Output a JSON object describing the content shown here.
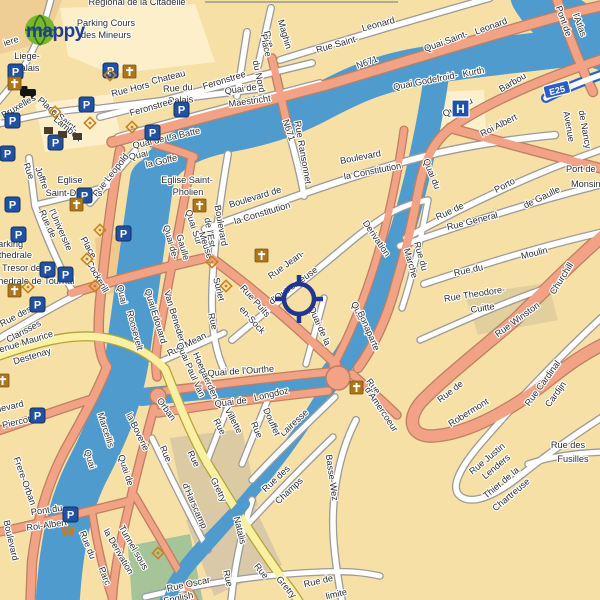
{
  "logo": {
    "text": "mappy"
  },
  "colors": {
    "land": "#f7e0a6",
    "water": "#4f9bce",
    "road_major": "#f2a285",
    "road_major_casing": "#bc8064",
    "road_secondary": "#f9f0a2",
    "road_secondary_casing": "#b3a43c",
    "road_minor": "#ffffff",
    "road_minor_casing": "#9b9b9b",
    "motorway": "#2b5fc7",
    "park": "#a5c497",
    "parking_blue": "#2151a3",
    "poi_orange": "#ad761c",
    "monument_orange": "#c8821c",
    "label_color": "#2e2e2e",
    "crosshair_color": "#22368f"
  },
  "crosshair": {
    "x": 299,
    "y": 299
  },
  "badges": [
    {
      "text": "E25",
      "x": 557,
      "y": 90,
      "r": -14
    }
  ],
  "labels": [
    {
      "t": "Regional de la Citadelle",
      "x": 137,
      "y": 5
    },
    {
      "t": "iere",
      "x": 12,
      "y": 44,
      "r": -18
    },
    {
      "t": "Parking Cours",
      "x": 106,
      "y": 26
    },
    {
      "t": "des Mineurs",
      "x": 106,
      "y": 38
    },
    {
      "t": "Liege-",
      "x": 27,
      "y": 59
    },
    {
      "t": "Palais",
      "x": 27,
      "y": 71
    },
    {
      "t": "Rue du",
      "x": 178,
      "y": 91,
      "r": -4
    },
    {
      "t": "Palais",
      "x": 181,
      "y": 103,
      "r": -4
    },
    {
      "t": "Rue Hors",
      "x": 131,
      "y": 92,
      "r": -14
    },
    {
      "t": "Chateau",
      "x": 169,
      "y": 80,
      "r": -14
    },
    {
      "t": "Feronstree",
      "x": 152,
      "y": 110,
      "r": -16
    },
    {
      "t": "Feronstree",
      "x": 225,
      "y": 83,
      "r": -17
    },
    {
      "t": "Rue",
      "x": 266,
      "y": 40,
      "r": 74
    },
    {
      "t": "Maghin",
      "x": 282,
      "y": 35,
      "r": 74
    },
    {
      "t": "Place",
      "x": 263,
      "y": 46,
      "r": 78
    },
    {
      "t": "du Nord",
      "x": 256,
      "y": 77,
      "r": 78
    },
    {
      "t": "Rue Saint-",
      "x": 338,
      "y": 47,
      "r": -16
    },
    {
      "t": "Leonard",
      "x": 379,
      "y": 27,
      "r": -15
    },
    {
      "t": "N671",
      "x": 368,
      "y": 65,
      "r": -20
    },
    {
      "t": "Quai de",
      "x": 241,
      "y": 92,
      "r": -8
    },
    {
      "t": "Maestricht",
      "x": 250,
      "y": 104,
      "r": -8
    },
    {
      "t": "Quai Saint-",
      "x": 447,
      "y": 44,
      "r": -20
    },
    {
      "t": "Leonard",
      "x": 492,
      "y": 29,
      "r": -20
    },
    {
      "t": "Quai Godefroid-",
      "x": 426,
      "y": 84,
      "r": -11
    },
    {
      "t": "Kurth",
      "x": 474,
      "y": 75,
      "r": -11
    },
    {
      "t": "Pont de",
      "x": 561,
      "y": 22,
      "r": 70
    },
    {
      "t": "l'Atlas",
      "x": 577,
      "y": 26,
      "r": 70
    },
    {
      "t": "Quai du",
      "x": 459,
      "y": 110,
      "r": -27
    },
    {
      "t": "Barbou",
      "x": 514,
      "y": 85,
      "r": -30
    },
    {
      "t": "Roi Albert",
      "x": 500,
      "y": 128,
      "r": -27
    },
    {
      "t": "Avenue",
      "x": 566,
      "y": 127,
      "r": 80
    },
    {
      "t": "de Nancy",
      "x": 582,
      "y": 130,
      "r": 80
    },
    {
      "t": "Quai du",
      "x": 429,
      "y": 175,
      "r": 68
    },
    {
      "t": "N671",
      "x": 286,
      "y": 131,
      "r": 72
    },
    {
      "t": "Quai",
      "x": 139,
      "y": 158,
      "r": -13
    },
    {
      "t": "la Goffe",
      "x": 162,
      "y": 164,
      "r": -13
    },
    {
      "t": "Quai de La Batte",
      "x": 167,
      "y": 141,
      "r": -13
    },
    {
      "t": "Rue Leopold",
      "x": 113,
      "y": 177,
      "r": -52
    },
    {
      "t": "Eglise Saint-",
      "x": 187,
      "y": 183
    },
    {
      "t": "Pholien",
      "x": 188,
      "y": 195
    },
    {
      "t": "Eglise",
      "x": 70,
      "y": 183
    },
    {
      "t": "Saint-D",
      "x": 61,
      "y": 196
    },
    {
      "t": "s",
      "x": 100,
      "y": 196
    },
    {
      "t": "Rue",
      "x": 26,
      "y": 172,
      "r": 70
    },
    {
      "t": "Joffre",
      "x": 39,
      "y": 179,
      "r": 70
    },
    {
      "t": "Place Saint-",
      "x": 56,
      "y": 117,
      "r": 40
    },
    {
      "t": "Lambert",
      "x": 66,
      "y": 131,
      "r": 40
    },
    {
      "t": "Rue de Bruxelles",
      "x": 6,
      "y": 117,
      "r": -30
    },
    {
      "t": "Boulevard de",
      "x": 256,
      "y": 200,
      "r": -17
    },
    {
      "t": "la Constitution",
      "x": 263,
      "y": 216,
      "r": -17
    },
    {
      "t": "Boulevard",
      "x": 361,
      "y": 160,
      "r": -11
    },
    {
      "t": "la Constitution",
      "x": 373,
      "y": 174,
      "r": -11
    },
    {
      "t": "Rue Ransonnet",
      "x": 300,
      "y": 153,
      "r": 80
    },
    {
      "t": "Boulevard",
      "x": 218,
      "y": 226,
      "r": 80
    },
    {
      "t": "de l'Est",
      "x": 207,
      "y": 233,
      "r": 80
    },
    {
      "t": "Quai Sur",
      "x": 191,
      "y": 228,
      "r": 72
    },
    {
      "t": "Meuse",
      "x": 203,
      "y": 246,
      "r": 72
    },
    {
      "t": "Quai de-",
      "x": 168,
      "y": 243,
      "r": 74
    },
    {
      "t": "Gaulle",
      "x": 180,
      "y": 248,
      "r": 74
    },
    {
      "t": "Quai",
      "x": 119,
      "y": 295,
      "r": 78
    },
    {
      "t": "Roosevelt",
      "x": 132,
      "y": 331,
      "r": 75
    },
    {
      "t": "Quai Edouard",
      "x": 153,
      "y": 317,
      "r": 73
    },
    {
      "t": "Van Beneden",
      "x": 172,
      "y": 318,
      "r": 73
    },
    {
      "t": "Rue de",
      "x": 45,
      "y": 225,
      "r": 66
    },
    {
      "t": "l'Universite",
      "x": 58,
      "y": 231,
      "r": 66
    },
    {
      "t": "Place",
      "x": 86,
      "y": 249,
      "r": 60
    },
    {
      "t": "Cockerill",
      "x": 95,
      "y": 278,
      "r": 60
    },
    {
      "t": "Parking",
      "x": -8,
      "y": 247,
      "a": "s"
    },
    {
      "t": "Cathedrale",
      "x": -13,
      "y": 258,
      "a": "s"
    },
    {
      "t": "Tresor de la",
      "x": 2,
      "y": 271,
      "a": "s"
    },
    {
      "t": "Cathedrale de Tournai",
      "x": -16,
      "y": 284,
      "a": "s"
    },
    {
      "t": "Rue des",
      "x": 17,
      "y": 319,
      "r": -28
    },
    {
      "t": "Clarisses",
      "x": 25,
      "y": 334,
      "r": -28
    },
    {
      "t": "Avenue Maurice",
      "x": 22,
      "y": 346,
      "r": -17
    },
    {
      "t": "Destenay",
      "x": 33,
      "y": 359,
      "r": -17
    },
    {
      "t": "Boulevard",
      "x": 4,
      "y": 411,
      "r": -13
    },
    {
      "t": "Piercot",
      "x": 17,
      "y": 425,
      "r": -13
    },
    {
      "t": "Rue Jean-",
      "x": 288,
      "y": 267,
      "r": -36
    },
    {
      "t": "d'Outremeuse",
      "x": 295,
      "y": 288,
      "r": -36
    },
    {
      "t": "Rue Puits",
      "x": 253,
      "y": 303,
      "r": 48
    },
    {
      "t": "en-Sock",
      "x": 250,
      "y": 322,
      "r": 48
    },
    {
      "t": "Surlet",
      "x": 216,
      "y": 290,
      "r": 76
    },
    {
      "t": "Rue",
      "x": 210,
      "y": 322,
      "r": 76
    },
    {
      "t": "Rue Mean",
      "x": 188,
      "y": 347,
      "r": -27
    },
    {
      "t": "Derivation",
      "x": 374,
      "y": 240,
      "r": 56
    },
    {
      "t": "Quai de la",
      "x": 317,
      "y": 327,
      "r": 66
    },
    {
      "t": "Quai",
      "x": 355,
      "y": 312,
      "r": 66
    },
    {
      "t": "Bonaparte",
      "x": 366,
      "y": 332,
      "r": 66
    },
    {
      "t": "Rue du",
      "x": 418,
      "y": 257,
      "r": 74
    },
    {
      "t": "Marche",
      "x": 408,
      "y": 264,
      "r": 74
    },
    {
      "t": "Rue de",
      "x": 451,
      "y": 214,
      "r": -25
    },
    {
      "t": "Porto",
      "x": 506,
      "y": 188,
      "r": -28
    },
    {
      "t": "Rue General",
      "x": 473,
      "y": 224,
      "r": -14
    },
    {
      "t": "de Gaulle",
      "x": 543,
      "y": 200,
      "r": -26
    },
    {
      "t": "Rue du",
      "x": 469,
      "y": 273,
      "r": -12
    },
    {
      "t": "Moulin",
      "x": 535,
      "y": 256,
      "r": -14
    },
    {
      "t": "Port de",
      "x": 566,
      "y": 172,
      "a": "s"
    },
    {
      "t": "Monsin",
      "x": 571,
      "y": 187,
      "a": "s"
    },
    {
      "t": "Rue Theodore-",
      "x": 475,
      "y": 297,
      "r": -9
    },
    {
      "t": "Cuitte",
      "x": 483,
      "y": 311,
      "r": -9
    },
    {
      "t": "Churchill",
      "x": 564,
      "y": 280,
      "r": -58
    },
    {
      "t": "Rue Winston",
      "x": 519,
      "y": 322,
      "r": -36
    },
    {
      "t": "Rue de",
      "x": 452,
      "y": 394,
      "r": -38
    },
    {
      "t": "Robermont",
      "x": 470,
      "y": 415,
      "r": -32
    },
    {
      "t": "Rue Cardinal",
      "x": 545,
      "y": 385,
      "r": -54
    },
    {
      "t": "Cardijn",
      "x": 558,
      "y": 396,
      "r": -54
    },
    {
      "t": "Rue Justin",
      "x": 489,
      "y": 461,
      "r": -40
    },
    {
      "t": "Lenders",
      "x": 498,
      "y": 469,
      "r": -40
    },
    {
      "t": "Thier de la",
      "x": 503,
      "y": 485,
      "r": -40
    },
    {
      "t": "Chartreuse",
      "x": 513,
      "y": 497,
      "r": -40
    },
    {
      "t": "Rue des",
      "x": 568,
      "y": 448
    },
    {
      "t": "Fusilles",
      "x": 573,
      "y": 462
    },
    {
      "t": "Rue",
      "x": 371,
      "y": 388,
      "r": 52
    },
    {
      "t": "d'Amercoeur",
      "x": 379,
      "y": 411,
      "r": 56
    },
    {
      "t": "Quai de l'Ourthe",
      "x": 241,
      "y": 374,
      "r": -4
    },
    {
      "t": "Quai de",
      "x": 231,
      "y": 405,
      "r": -7
    },
    {
      "t": "Longdoz",
      "x": 272,
      "y": 397,
      "r": -13
    },
    {
      "t": "Quai Paul Van",
      "x": 188,
      "y": 371,
      "r": 66
    },
    {
      "t": "Hoegaerden",
      "x": 203,
      "y": 377,
      "r": 66
    },
    {
      "t": "Orban",
      "x": 164,
      "y": 411,
      "r": 54
    },
    {
      "t": "la Boverie",
      "x": 135,
      "y": 433,
      "r": 64
    },
    {
      "t": "Quai de",
      "x": 123,
      "y": 471,
      "r": 72
    },
    {
      "t": "Marcellis",
      "x": 103,
      "y": 431,
      "r": 72
    },
    {
      "t": "Quai",
      "x": 87,
      "y": 460,
      "r": 72
    },
    {
      "t": "Frere-Orban",
      "x": 22,
      "y": 482,
      "r": 70
    },
    {
      "t": "Boulevard",
      "x": 8,
      "y": 541,
      "r": 77
    },
    {
      "t": "Pont du",
      "x": 47,
      "y": 513,
      "r": -8
    },
    {
      "t": "Roi-Albert",
      "x": 47,
      "y": 528,
      "r": -8
    },
    {
      "t": "Rue du",
      "x": 85,
      "y": 546,
      "r": 68
    },
    {
      "t": "Parc",
      "x": 102,
      "y": 577,
      "r": 68
    },
    {
      "t": "Tunnel sous",
      "x": 131,
      "y": 549,
      "r": 60
    },
    {
      "t": "la Derivation",
      "x": 116,
      "y": 553,
      "r": 60
    },
    {
      "t": "Rue",
      "x": 163,
      "y": 455,
      "r": 66
    },
    {
      "t": "d'Harscamp",
      "x": 192,
      "y": 507,
      "r": 66
    },
    {
      "t": "Rue Oscar",
      "x": 189,
      "y": 587,
      "r": -12
    },
    {
      "t": "English",
      "x": 179,
      "y": 601,
      "r": -12
    },
    {
      "t": "Natalis",
      "x": 237,
      "y": 531,
      "r": 76
    },
    {
      "t": "Rue",
      "x": 225,
      "y": 579,
      "r": 76
    },
    {
      "t": "Rue",
      "x": 191,
      "y": 460,
      "r": 64
    },
    {
      "t": "Gretry",
      "x": 216,
      "y": 491,
      "r": 64
    },
    {
      "t": "Rue",
      "x": 259,
      "y": 573,
      "r": 50
    },
    {
      "t": "Gretry",
      "x": 284,
      "y": 589,
      "r": 50
    },
    {
      "t": "Rue des",
      "x": 278,
      "y": 481,
      "r": -43
    },
    {
      "t": "Champs",
      "x": 291,
      "y": 493,
      "r": -43
    },
    {
      "t": "Basse-Wez",
      "x": 329,
      "y": 478,
      "r": 82
    },
    {
      "t": "Lairesse",
      "x": 296,
      "y": 425,
      "r": -43
    },
    {
      "t": "Rue",
      "x": 254,
      "y": 431,
      "r": 66
    },
    {
      "t": "Douffet",
      "x": 269,
      "y": 423,
      "r": 66
    },
    {
      "t": "Rue",
      "x": 217,
      "y": 428,
      "r": 62
    },
    {
      "t": "Villette",
      "x": 231,
      "y": 422,
      "r": 62
    },
    {
      "t": "Rue de",
      "x": 319,
      "y": 584,
      "r": -13
    },
    {
      "t": "limite",
      "x": 337,
      "y": 597,
      "r": -13
    }
  ],
  "icons": {
    "parking": [
      [
        103,
        63
      ],
      [
        8,
        64
      ],
      [
        5,
        113
      ],
      [
        79,
        97
      ],
      [
        48,
        135
      ],
      [
        0,
        146
      ],
      [
        5,
        197
      ],
      [
        77,
        188
      ],
      [
        11,
        227
      ],
      [
        40,
        262
      ],
      [
        116,
        226
      ],
      [
        58,
        267
      ],
      [
        30,
        297
      ],
      [
        30,
        408
      ],
      [
        63,
        507
      ],
      [
        145,
        125
      ],
      [
        174,
        102
      ]
    ],
    "church": [
      [
        8,
        77
      ],
      [
        123,
        65
      ],
      [
        70,
        198
      ],
      [
        193,
        199
      ],
      [
        255,
        249
      ],
      [
        350,
        381
      ],
      [
        8,
        284
      ],
      [
        -4,
        374
      ]
    ],
    "monument": [
      [
        55,
        112
      ],
      [
        90,
        123
      ],
      [
        132,
        127
      ],
      [
        110,
        75
      ],
      [
        100,
        230
      ],
      [
        87,
        259
      ],
      [
        212,
        262
      ],
      [
        226,
        286
      ],
      [
        28,
        287
      ],
      [
        95,
        286
      ],
      [
        158,
        553
      ]
    ],
    "station": [
      [
        20,
        86
      ]
    ],
    "hospital": [
      [
        452,
        100
      ]
    ],
    "phone": [
      [
        60,
        524
      ]
    ],
    "building": [
      [
        44,
        127
      ],
      [
        58,
        131
      ],
      [
        73,
        133
      ]
    ]
  }
}
